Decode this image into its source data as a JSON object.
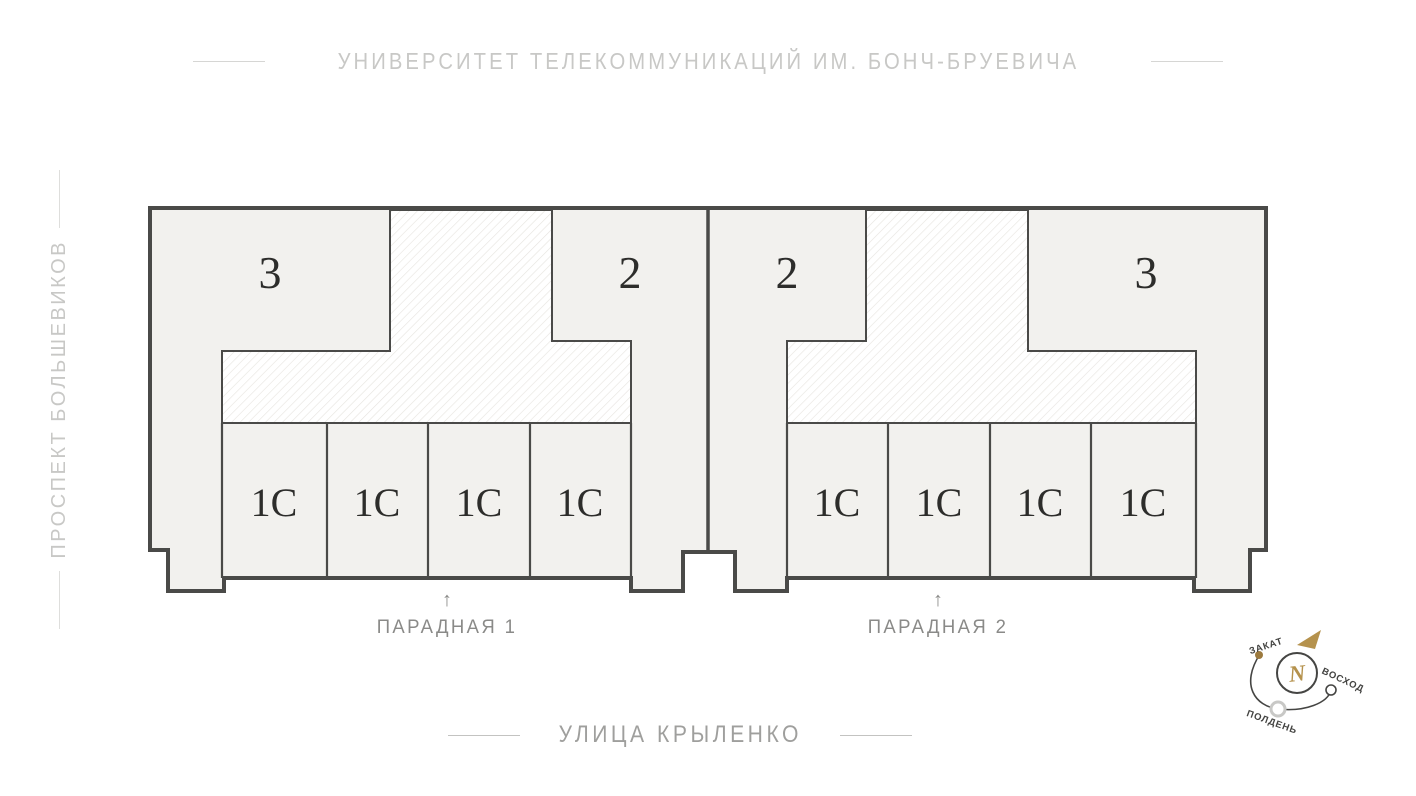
{
  "streets": {
    "top": "УНИВЕРСИТЕТ ТЕЛЕКОММУНИКАЦИЙ ИМ. БОНЧ-БРУЕВИЧА",
    "left": "ПРОСПЕКТ БОЛЬШЕВИКОВ",
    "bottom": "УЛИЦА КРЫЛЕНКО"
  },
  "plan": {
    "building1": {
      "apartment_left": "3",
      "apartment_right": "2",
      "studios": [
        "1С",
        "1С",
        "1С",
        "1С"
      ],
      "entrance": {
        "arrow": "↑",
        "label": "ПАРАДНАЯ 1"
      }
    },
    "building2": {
      "apartment_left": "2",
      "apartment_right": "3",
      "studios": [
        "1С",
        "1С",
        "1С",
        "1С"
      ],
      "entrance": {
        "arrow": "↑",
        "label": "ПАРАДНАЯ 2"
      }
    }
  },
  "compass": {
    "north": "N",
    "sunset": "ЗАКАТ",
    "sunrise": "ВОСХОД",
    "noon": "ПОЛДЕНЬ"
  },
  "colors": {
    "building_fill": "#f2f1ee",
    "wall": "#4a4a48",
    "hatch_line": "#e6e4df",
    "gold": "#b5924d",
    "sunset_dot": "#9c7a3e",
    "street_label": "#c8c8c6",
    "street_label_dark": "#9f9f9d",
    "entrance_label": "#8a8a88",
    "apartment_number": "#2d2d2b"
  }
}
